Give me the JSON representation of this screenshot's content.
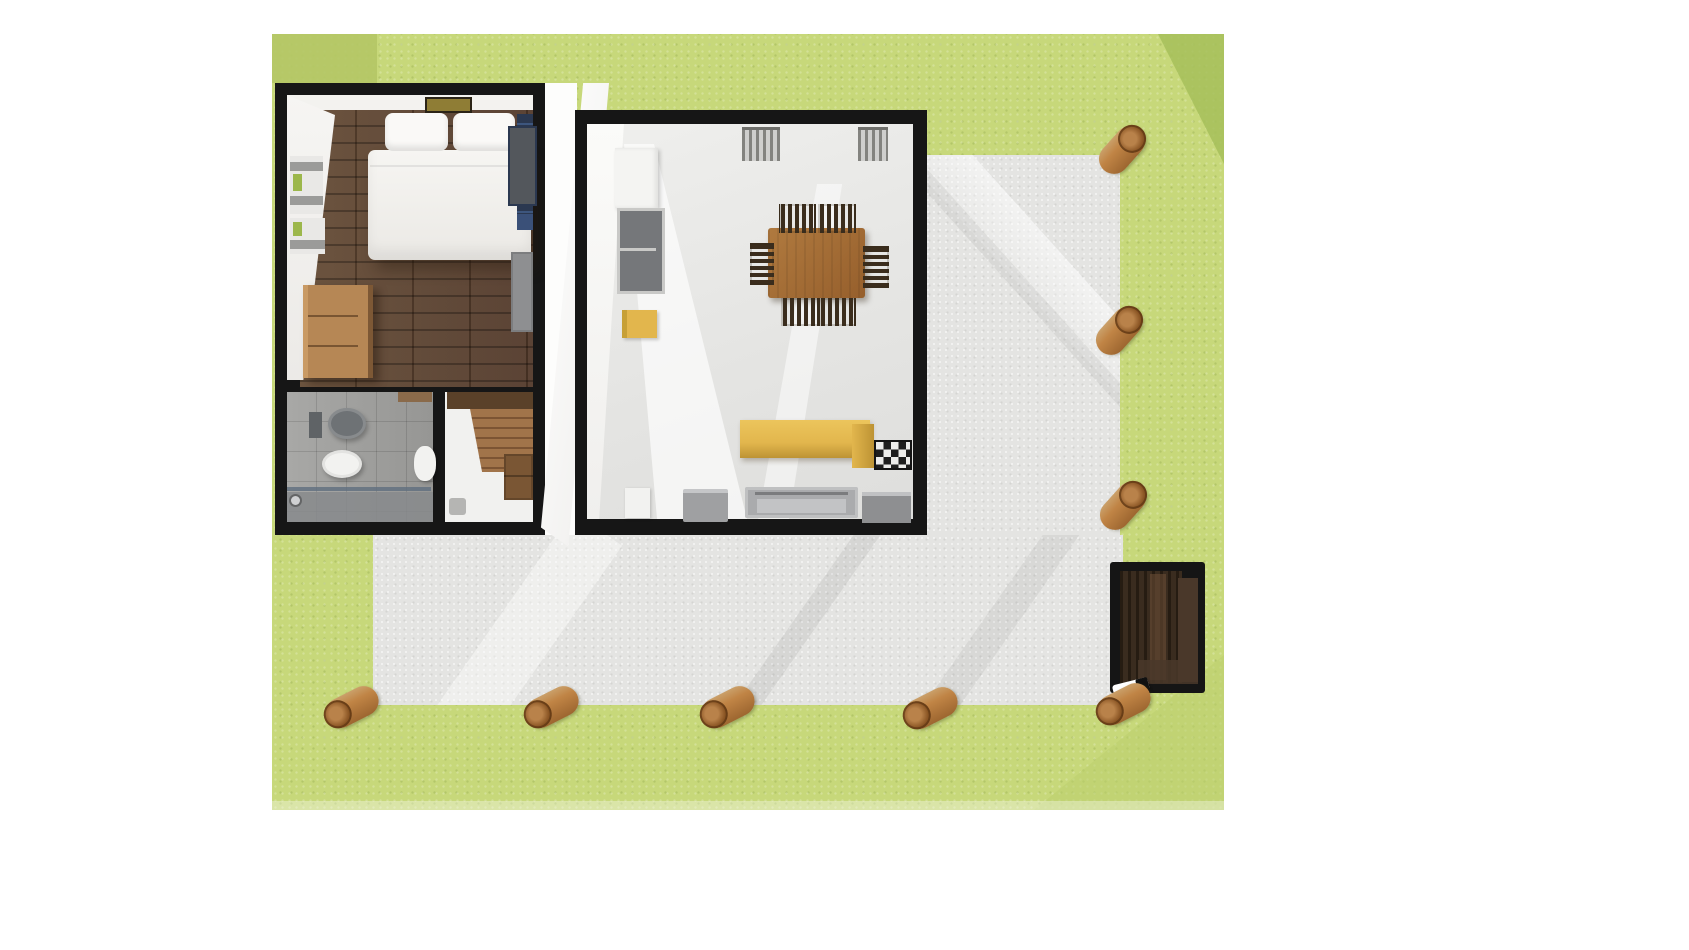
{
  "meta": {
    "title": "3D top-down floor plan render - lodge with wraparound deck",
    "view": "top-down 3D architectural render",
    "canvas": {
      "width": 1689,
      "height": 950
    },
    "visible_text": "none"
  },
  "rooms": [
    {
      "id": "bedroom",
      "label": "Bedroom",
      "furniture": [
        "double bed with two pillows",
        "skylight vent",
        "wall shelves with green books",
        "bunk bed (navy)",
        "grey wardrobe mat",
        "wooden dresser",
        "dark plank wood floor"
      ]
    },
    {
      "id": "bathroom",
      "label": "Bathroom",
      "furniture": [
        "wall-hung toilet",
        "cistern box",
        "white bidet",
        "washbasin",
        "walk-in shower with glass screen",
        "wooden shelf",
        "grey tile floor"
      ]
    },
    {
      "id": "stair-room",
      "label": "Hall / Staircase",
      "furniture": [
        "dark wood landing",
        "wooden staircase",
        "storage cabinet",
        "small grey bin"
      ]
    },
    {
      "id": "kitchen",
      "label": "Kitchen / Dining room",
      "furniture": [
        "fridge (white tall unit)",
        "grey oven stack",
        "yellow bar stool",
        "wooden dining table",
        "six dark wooden chairs",
        "yellow L-shaped counter",
        "gas hob (checkered)",
        "white appliance",
        "grey appliance",
        "long grey oven",
        "grey counter piece",
        "two window blinds"
      ]
    }
  ],
  "exterior": {
    "lawn": "green grass surrounding the cabin",
    "deck": "light grey L-shaped terrace along right side and bottom",
    "timber_posts": {
      "bottom_row": 5,
      "right_column": 3,
      "material": "round timber logs"
    },
    "wood_store": "black louvered box (stove/wood store) at deck bottom-right corner",
    "chimney": "white flue elbow with black tip at wood store base",
    "open_door": "white door leaf ajar between bedroom block and kitchen block"
  },
  "palette": {
    "bg": "#ffffff",
    "grass": "#c7d87a",
    "grassDark": "#b4c765",
    "grassDarker": "#a6c05a",
    "grassShade": "#bcd06e",
    "deck": "#e4e4e2",
    "wall": "#161616",
    "woodFloor": "#5b4330",
    "bedWhite": "#f3f2ef",
    "pillow": "#faf9f7",
    "shelfGray": "#9b9b99",
    "shelfGreen": "#9cb74b",
    "bunkNavy": "#2b3850",
    "bunkGray": "#53575c",
    "bunkBlue": "#3a5078",
    "matGray": "#8e8f91",
    "dresser": "#b68755",
    "dresserLight": "#c99a64",
    "dresserDark": "#7d5835",
    "skylight": "#8f7d35",
    "bathFloor": "#a2a2a0",
    "showerGray": "#87898c",
    "glassBlue": "#5f6e7e",
    "fixtureWhite": "#f2f2f0",
    "toiletGray": "#6e7275",
    "stairsWood": "#a1744a",
    "stairsDark": "#5a4129",
    "cabinetWood": "#7a5634",
    "kitchenFloor": "#e7e7e5",
    "applianceGray": "#75777a",
    "fridgeWhite": "#f4f4f2",
    "radiator": "#83837f",
    "radiatorBg": "#cfcfcd",
    "tableWood": "#a76f38",
    "chairDark": "#3b2d1d",
    "counterYellow": "#e2b64d",
    "counterYellowDark": "#bd9334",
    "hobDark": "#1e1e1e",
    "hobLight": "#ececea",
    "ovenGray": "#aaabad",
    "boxBlack": "#151515",
    "boxSlat": "#3a2c1f",
    "boxSlatDark": "#261c12",
    "boxBrown": "#4a382a",
    "boxLightBrown": "#6d5136",
    "postWood": "#c08445",
    "postWoodDark": "#8a5524"
  }
}
